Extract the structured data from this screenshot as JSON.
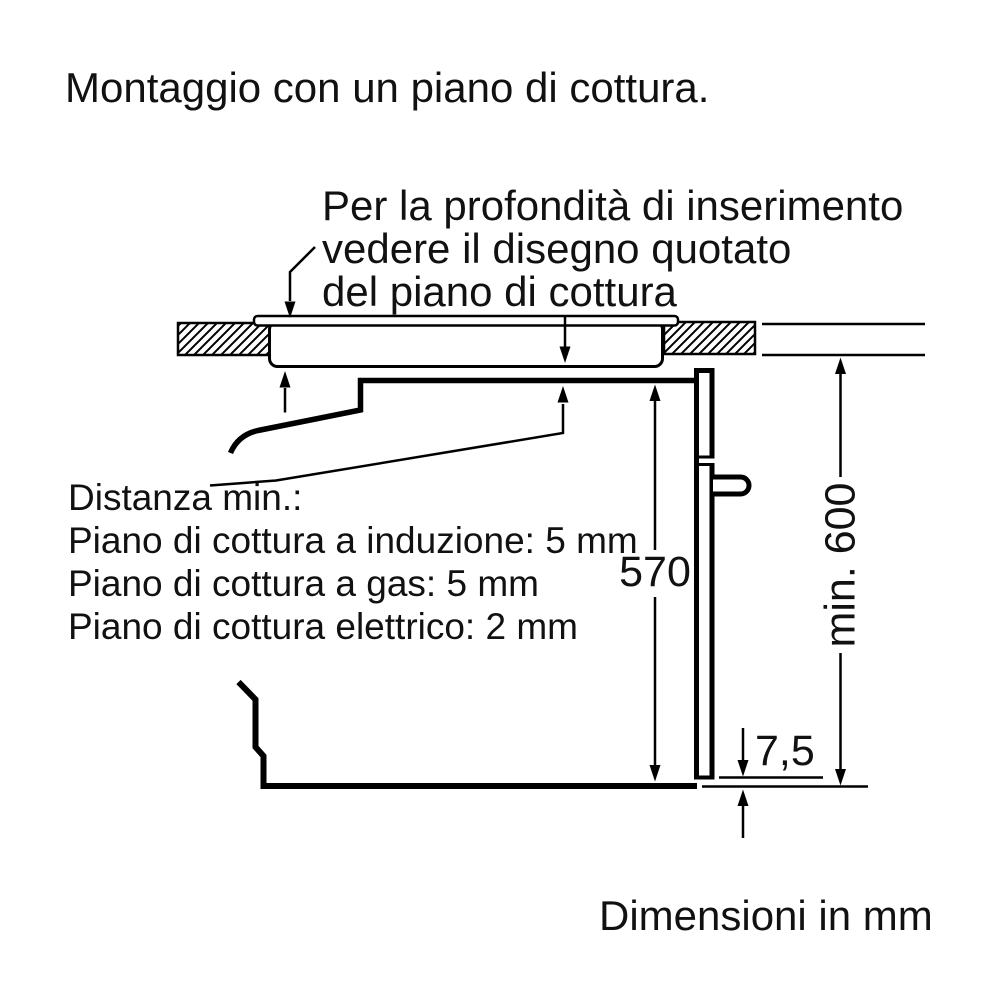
{
  "title": "Montaggio con un piano di cottura.",
  "annotation": {
    "line1": "Per la profondità di inserimento",
    "line2": "vedere il disegno quotato",
    "line3": "del piano di cottura"
  },
  "distances": {
    "heading": "Distanza min.:",
    "items": [
      "Piano di cottura a induzione: 5 mm",
      "Piano di cottura a gas: 5 mm",
      "Piano di cottura elettrico: 2 mm"
    ]
  },
  "dimensions": {
    "oven_height_mm": "570",
    "niche_height_mm": "min. 600",
    "bottom_gap_mm": "7,5"
  },
  "footer": "Dimensioni in mm",
  "colors": {
    "line": "#000000",
    "background": "#ffffff",
    "text": "#111111"
  }
}
